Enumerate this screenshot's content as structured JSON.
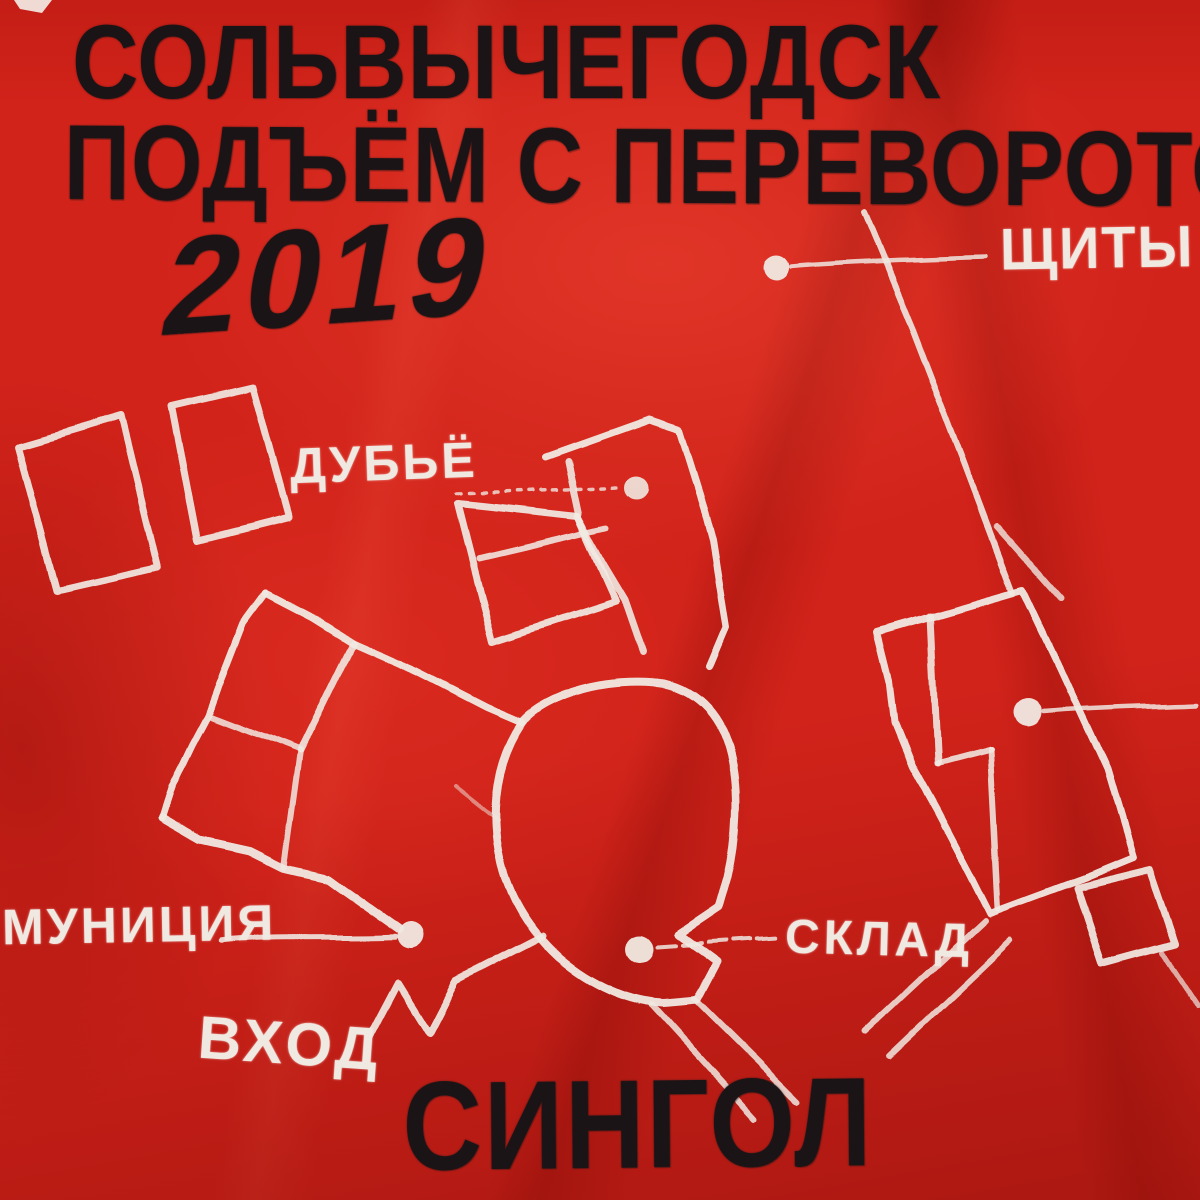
{
  "artwork": {
    "artist_or_place": "СОЛЬВЫЧЕГОДСК",
    "title": "ПОДЪЁМ С ПЕРЕВОРОТОМ",
    "year": "2019",
    "release_type": "СИНГОЛ"
  },
  "map_labels": {
    "shields": "ЩИТЫ",
    "dubyo": "ДУБЬЁ",
    "ammunition": "МУНИЦИЯ",
    "warehouse": "СКЛАД",
    "entrance": "ВХОД"
  },
  "colors": {
    "fabric_red": "#d2231a",
    "paint_black": "#1a1416",
    "paint_white": "#f0e9e2"
  }
}
